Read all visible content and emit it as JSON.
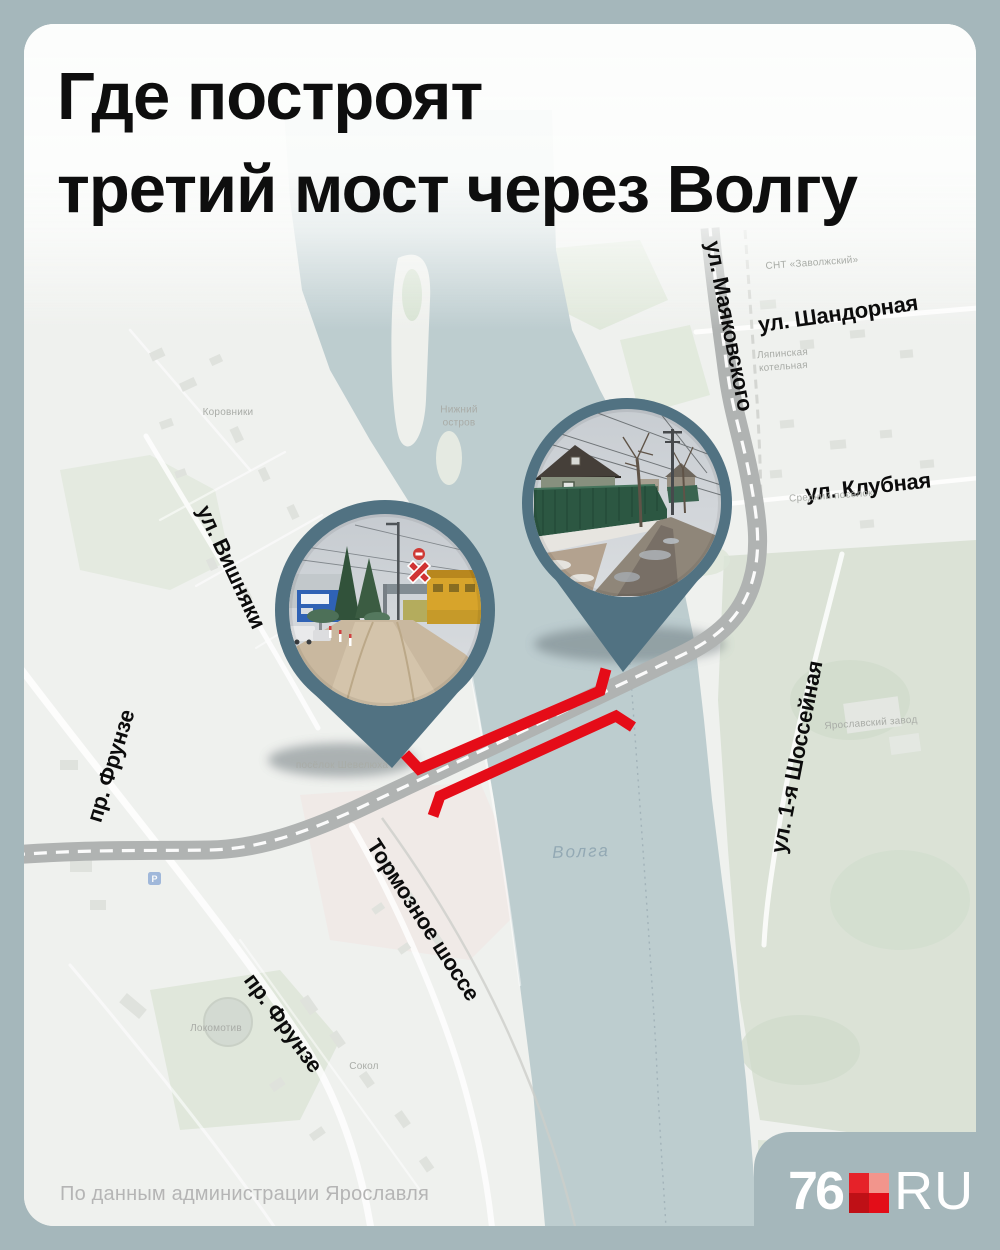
{
  "title": {
    "line1": "Где построят",
    "line2": "третий мост через Волгу"
  },
  "street_labels": [
    {
      "id": "mayakovskogo",
      "text": "ул. Маяковского"
    },
    {
      "id": "shandornaya",
      "text": "ул. Шандорная"
    },
    {
      "id": "klubnaya",
      "text": "ул. Клубная"
    },
    {
      "id": "vishnyaki",
      "text": "ул. Вишняки"
    },
    {
      "id": "frunze-upper",
      "text": "пр. Фрунзе"
    },
    {
      "id": "shosseinaya",
      "text": "ул. 1-я Шоссейная"
    },
    {
      "id": "tormoznoe",
      "text": "Тормозное шоссе"
    },
    {
      "id": "frunze-lower",
      "text": "пр. Фрунзе"
    }
  ],
  "map": {
    "river_label": "Волга",
    "micro_labels": [
      {
        "text": "Коровники"
      },
      {
        "text": "Нижний\nостров"
      },
      {
        "text": "посёлок Шевелюха"
      },
      {
        "text": "Средний посёлок"
      },
      {
        "text": "Ляпинская\nкотельная"
      },
      {
        "text": "СНТ «Заволжский»"
      },
      {
        "text": "Ярославский завод"
      },
      {
        "text": "Сокол"
      },
      {
        "text": "Локомотив"
      }
    ],
    "parking_label": "P"
  },
  "markers": [
    {
      "id": "pin-left",
      "photo_description": "дорога у железнодорожного переезда"
    },
    {
      "id": "pin-right",
      "photo_description": "улица частного сектора с зелёным забором"
    }
  ],
  "footer": {
    "source": "По данным администрации Ярославля"
  },
  "logo": {
    "number": "76",
    "domain": "RU"
  },
  "colors": {
    "frame": "#a5b7bb",
    "river": "#b4c6c9",
    "land": "#edefec",
    "road": "#b0b3b2",
    "bridge_highlight": "#e50c18",
    "pin": "#517282",
    "title_text": "#0e0e0e",
    "footer_text": "#b5b5b5",
    "logo_red_tl": "#e62229",
    "logo_red_tr": "#f2958c",
    "logo_red_bl": "#bf1016",
    "logo_red_br": "#e30d18"
  }
}
